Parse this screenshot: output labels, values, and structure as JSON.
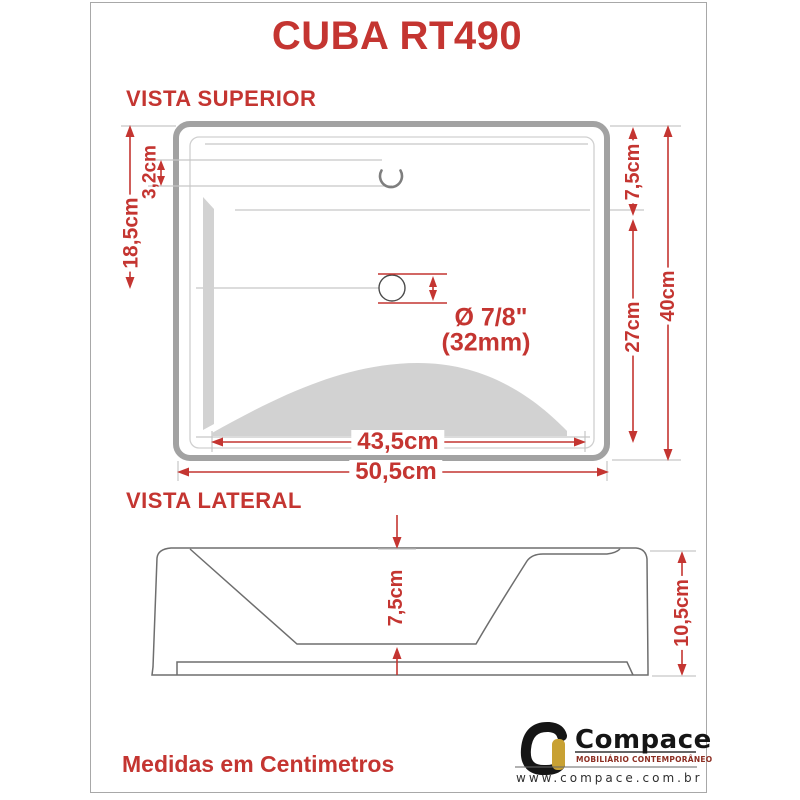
{
  "title": "CUBA RT490",
  "colors": {
    "dimension_red": "#c43531",
    "drawing_outline_gray": "#a2a2a2",
    "shading_gray": "#d2d2d2",
    "brand_black": "#151515",
    "brand_gold": "#c8a133",
    "brand_tagline_red": "#8d2e22"
  },
  "top_view": {
    "label": "VISTA SUPERIOR",
    "dimensions": {
      "edge_to_drain": "18,5cm",
      "deck_depth": "3,2cm",
      "top_to_basin": "7,5cm",
      "basin_length": "27cm",
      "total_depth": "40cm",
      "inner_width": "43,5cm",
      "total_width": "50,5cm"
    },
    "drain_note": {
      "line1": "Ø 7/8\"",
      "line2": "(32mm)"
    }
  },
  "side_view": {
    "label": "VISTA LATERAL",
    "dimensions": {
      "basin_depth": "7,5cm",
      "total_height": "10,5cm"
    }
  },
  "footer_note": "Medidas em Centimetros",
  "brand": {
    "name": "Compace",
    "tagline": "MOBILIÁRIO CONTEMPORÂNEO",
    "website": "www.compace.com.br"
  }
}
